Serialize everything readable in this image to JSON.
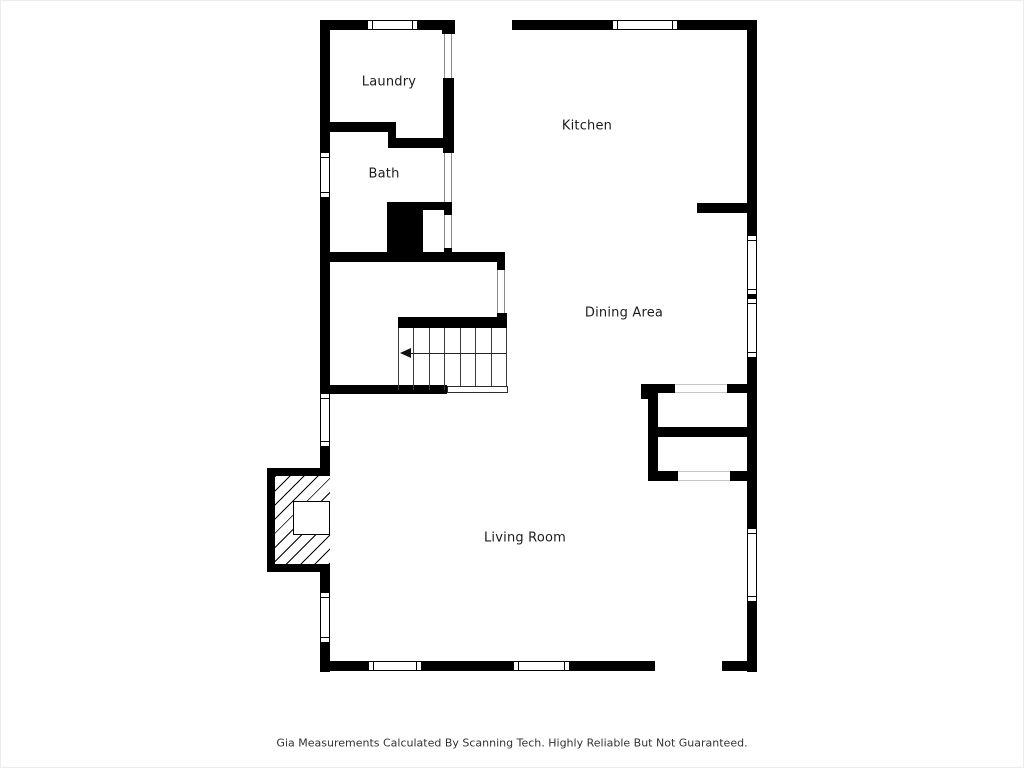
{
  "page": {
    "background": "#ffffff",
    "frame_border_color": "#ececec",
    "wall_color": "#000000",
    "label_color": "#1c1c1c",
    "jamb_line_color": "#8a8a8a",
    "faint_opening_line_color": "#c7c7c7"
  },
  "footer": {
    "text": "Gia Measurements Calculated By Scanning Tech. Highly Reliable But Not Guaranteed."
  },
  "rooms": [
    {
      "id": "laundry",
      "label": "Laundry",
      "x": 389,
      "y": 82
    },
    {
      "id": "kitchen",
      "label": "Kitchen",
      "x": 587,
      "y": 126
    },
    {
      "id": "bath",
      "label": "Bath",
      "x": 384,
      "y": 174
    },
    {
      "id": "dining-area",
      "label": "Dining Area",
      "x": 624,
      "y": 313
    },
    {
      "id": "living-room",
      "label": "Living Room",
      "x": 525,
      "y": 538
    }
  ],
  "floorplan": {
    "walls": [
      {
        "name": "exterior-top-left",
        "x": 320,
        "y": 20,
        "w": 135,
        "h": 10
      },
      {
        "name": "exterior-top-right",
        "x": 512,
        "y": 20,
        "w": 245,
        "h": 10
      },
      {
        "name": "exterior-left",
        "x": 320,
        "y": 20,
        "w": 10,
        "h": 652
      },
      {
        "name": "exterior-right",
        "x": 747,
        "y": 20,
        "w": 10,
        "h": 652
      },
      {
        "name": "exterior-bottom-left",
        "x": 320,
        "y": 661,
        "w": 335,
        "h": 10
      },
      {
        "name": "exterior-bottom-right",
        "x": 722,
        "y": 661,
        "w": 35,
        "h": 10
      },
      {
        "name": "laundry-door-block",
        "x": 442,
        "y": 20,
        "w": 13,
        "h": 14
      },
      {
        "name": "laundry-kitchen-wall",
        "x": 443,
        "y": 78,
        "w": 11,
        "h": 75
      },
      {
        "name": "laundry-bottom-wall",
        "x": 320,
        "y": 122,
        "w": 70,
        "h": 10
      },
      {
        "name": "laundry-step-pillar",
        "x": 388,
        "y": 122,
        "w": 8,
        "h": 26
      },
      {
        "name": "bath-top-wall",
        "x": 390,
        "y": 138,
        "w": 53,
        "h": 10
      },
      {
        "name": "chimney-mass",
        "x": 387,
        "y": 202,
        "w": 36,
        "h": 60
      },
      {
        "name": "nook-top-wall",
        "x": 423,
        "y": 202,
        "w": 27,
        "h": 8
      },
      {
        "name": "nook-jamb-top",
        "x": 444,
        "y": 202,
        "w": 8,
        "h": 13
      },
      {
        "name": "nook-jamb-bottom",
        "x": 444,
        "y": 248,
        "w": 8,
        "h": 14
      },
      {
        "name": "bath-bottom-wall",
        "x": 320,
        "y": 252,
        "w": 185,
        "h": 10
      },
      {
        "name": "hall-step-block",
        "x": 497,
        "y": 252,
        "w": 8,
        "h": 18
      },
      {
        "name": "stair-jamb-block",
        "x": 497,
        "y": 313,
        "w": 10,
        "h": 15
      },
      {
        "name": "stair-top-wall",
        "x": 398,
        "y": 317,
        "w": 109,
        "h": 11
      },
      {
        "name": "living-inner-wall",
        "x": 320,
        "y": 385,
        "w": 127,
        "h": 9
      },
      {
        "name": "kitchen-dining-stub",
        "x": 697,
        "y": 203,
        "w": 50,
        "h": 10
      },
      {
        "name": "closet-top-wall-left",
        "x": 641,
        "y": 384,
        "w": 34,
        "h": 9
      },
      {
        "name": "closet-top-tick",
        "x": 641,
        "y": 393,
        "w": 12,
        "h": 6
      },
      {
        "name": "closet-top-wall-right",
        "x": 727,
        "y": 384,
        "w": 20,
        "h": 9
      },
      {
        "name": "closet-left-wall",
        "x": 648,
        "y": 384,
        "w": 10,
        "h": 97
      },
      {
        "name": "closet-mid-wall",
        "x": 648,
        "y": 427,
        "w": 99,
        "h": 10
      },
      {
        "name": "closet-bottom-left",
        "x": 648,
        "y": 471,
        "w": 30,
        "h": 10
      },
      {
        "name": "closet-bottom-right",
        "x": 730,
        "y": 471,
        "w": 17,
        "h": 10
      }
    ],
    "windows": [
      {
        "name": "window-top-laundry",
        "x": 367,
        "y": 20,
        "w": 51,
        "h": 10,
        "orient": "h"
      },
      {
        "name": "window-top-kitchen",
        "x": 612,
        "y": 20,
        "w": 66,
        "h": 10,
        "orient": "h"
      },
      {
        "name": "window-left-bath",
        "x": 320,
        "y": 152,
        "w": 10,
        "h": 46,
        "orient": "v"
      },
      {
        "name": "window-left-living-1",
        "x": 320,
        "y": 393,
        "w": 10,
        "h": 54,
        "orient": "v"
      },
      {
        "name": "window-left-living-2",
        "x": 320,
        "y": 592,
        "w": 10,
        "h": 51,
        "orient": "v"
      },
      {
        "name": "window-right-dining-1",
        "x": 747,
        "y": 235,
        "w": 10,
        "h": 60,
        "orient": "v"
      },
      {
        "name": "window-right-dining-2",
        "x": 747,
        "y": 298,
        "w": 10,
        "h": 60,
        "orient": "v"
      },
      {
        "name": "window-right-living",
        "x": 747,
        "y": 528,
        "w": 10,
        "h": 74,
        "orient": "v"
      },
      {
        "name": "window-bottom-living-1",
        "x": 368,
        "y": 661,
        "w": 54,
        "h": 10,
        "orient": "h"
      },
      {
        "name": "window-bottom-living-2",
        "x": 513,
        "y": 661,
        "w": 57,
        "h": 10,
        "orient": "h"
      }
    ],
    "openings": [
      {
        "name": "opening-laundry-door",
        "x": 444,
        "y": 34,
        "w": 8,
        "h": 44,
        "orient": "v",
        "tone": "jamb"
      },
      {
        "name": "opening-bath-kitchen",
        "x": 444,
        "y": 153,
        "w": 8,
        "h": 49,
        "orient": "v",
        "tone": "jamb"
      },
      {
        "name": "opening-nook",
        "x": 444,
        "y": 215,
        "w": 8,
        "h": 33,
        "orient": "v",
        "tone": "jamb"
      },
      {
        "name": "opening-hall-dining",
        "x": 497,
        "y": 270,
        "w": 8,
        "h": 43,
        "orient": "v",
        "tone": "jamb"
      },
      {
        "name": "opening-closet-top",
        "x": 675,
        "y": 384,
        "w": 52,
        "h": 9,
        "orient": "h",
        "tone": "faint"
      },
      {
        "name": "opening-closet-bottom",
        "x": 678,
        "y": 471,
        "w": 52,
        "h": 10,
        "orient": "h",
        "tone": "faint"
      }
    ],
    "stairs": {
      "tread_area": {
        "x": 398,
        "y": 328,
        "w": 108,
        "h": 62
      },
      "tread_line_count": 8,
      "arrow": {
        "y": 353,
        "x1": 403,
        "x2": 506
      },
      "opening_box": {
        "x": 447,
        "y": 386,
        "w": 61,
        "h": 7
      }
    },
    "fireplace": {
      "outer": {
        "x": 267,
        "y": 468,
        "w": 63,
        "h": 104
      },
      "hatch": {
        "x": 275,
        "y": 476,
        "w": 55,
        "h": 88
      },
      "firebox": {
        "x": 293,
        "y": 501,
        "w": 37,
        "h": 34
      }
    }
  }
}
